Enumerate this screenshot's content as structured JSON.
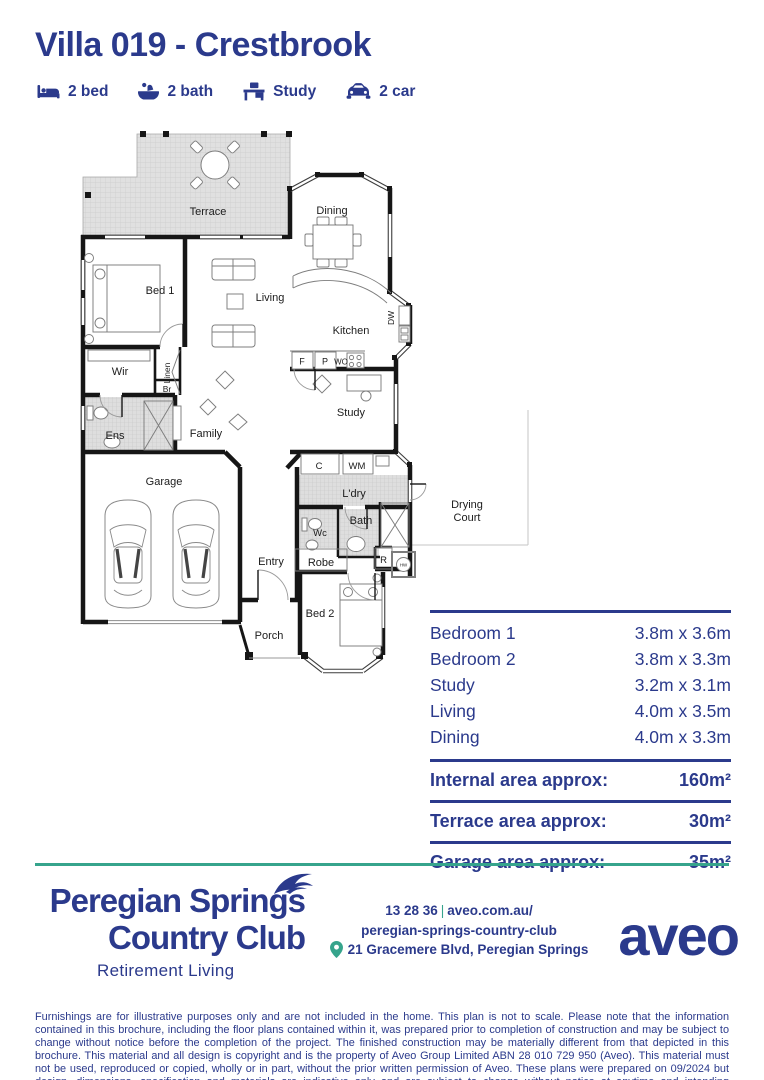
{
  "header": {
    "title": "Villa 019 - Crestbrook",
    "features": [
      {
        "icon": "bed-icon",
        "label": "2 bed"
      },
      {
        "icon": "bath-icon",
        "label": "2 bath"
      },
      {
        "icon": "study-icon",
        "label": "Study"
      },
      {
        "icon": "car-icon",
        "label": "2 car"
      }
    ]
  },
  "plan": {
    "labels": {
      "terrace": "Terrace",
      "dining": "Dining",
      "bed1": "Bed 1",
      "living": "Living",
      "kitchen": "Kitchen",
      "dw": "DW",
      "f": "F",
      "p": "P",
      "wo": "WO",
      "wir": "Wir",
      "linen": "Linen",
      "br": "Br",
      "ens": "Ens",
      "family": "Family",
      "study": "Study",
      "garage": "Garage",
      "c": "C",
      "wm": "WM",
      "ldry": "L'dry",
      "wc": "Wc",
      "bath": "Bath",
      "robe": "Robe",
      "r": "R",
      "hw": "HW",
      "entry": "Entry",
      "porch": "Porch",
      "bed2": "Bed 2",
      "drying_line1": "Drying",
      "drying_line2": "Court"
    }
  },
  "dimensions": {
    "rooms": [
      {
        "label": "Bedroom 1",
        "value": "3.8m x 3.6m"
      },
      {
        "label": "Bedroom 2",
        "value": "3.8m x 3.3m"
      },
      {
        "label": "Study",
        "value": "3.2m x 3.1m"
      },
      {
        "label": "Living",
        "value": "4.0m x 3.5m"
      },
      {
        "label": "Dining",
        "value": "4.0m x 3.3m"
      }
    ],
    "areas": [
      {
        "label": "Internal area approx:",
        "value": "160m²"
      },
      {
        "label": "Terrace area approx:",
        "value": "30m²"
      },
      {
        "label": "Garage area approx:",
        "value": "35m²"
      }
    ]
  },
  "footer": {
    "brand_line1": "Peregian Springs",
    "brand_line2": "Country Club",
    "brand_tagline": "Retirement Living",
    "contact_phone": "13 28 36",
    "contact_sep": "|",
    "contact_url1": "aveo.com.au/",
    "contact_url2": "peregian-springs-country-club",
    "address": "21 Gracemere Blvd, Peregian Springs",
    "aveo_logo": "aveo"
  },
  "disclaimer": "Furnishings are for illustrative purposes only and are not included in the home. This plan is not to scale. Please note that the information contained in this brochure, including the floor plans contained within it, was prepared prior to completion of construction and may be subject to change without notice before the completion of the project. The finished construction may be materially different from that depicted in this brochure. This material and all design is copyright and is the property of Aveo Group Limited ABN 28 010 729 950 (Aveo). This material must not be used, reproduced or copied, wholly or in part, without the prior written permission of Aveo. These plans were prepared on 09/2024 but design, dimensions, specification and materials are indicative only and are subject to change without notice at anytime and intending purchasers should undertake their own independent inquiries to satisfy themselves regarding the status of these plans. You should refer to appropriate Survey Plans for confirmation of individual unit areas.",
  "colors": {
    "navy": "#2b3a8c",
    "teal": "#36a48c"
  }
}
